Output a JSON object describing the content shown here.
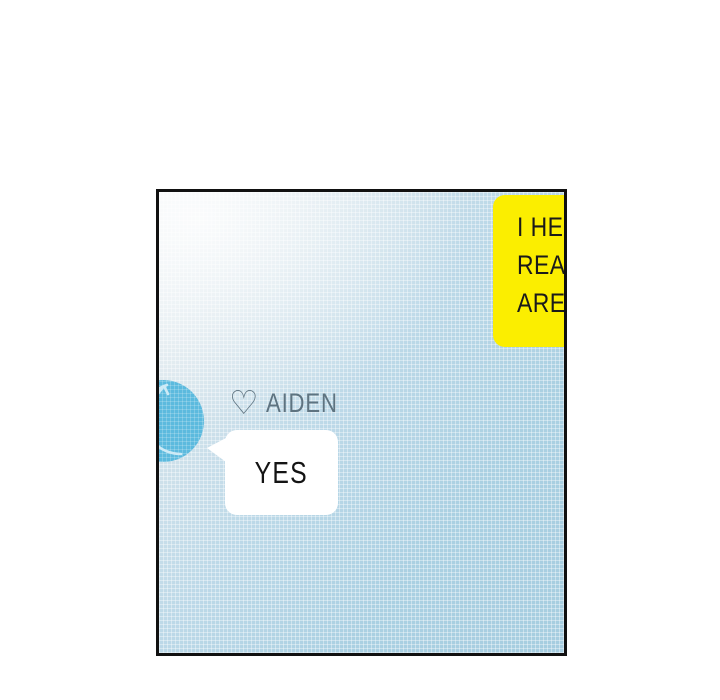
{
  "panel": {
    "yellow_bubble": {
      "lines": [
        "I HE",
        "REA",
        "ARE"
      ],
      "background": "#fbee00",
      "text_color": "#1a1a1a"
    },
    "character": {
      "heart_icon": "♡",
      "name": "AIDEN",
      "label_color": "#5e7380"
    },
    "white_bubble": {
      "text": "YES",
      "background": "#ffffff",
      "text_color": "#141414"
    },
    "colors": {
      "panel_border": "#111111",
      "background_light": "#eef2f4",
      "background_blue": "#a6cde0",
      "avatar_blue": "#5cbade",
      "avatar_sketch_line": "#cdeaf6",
      "page_background": "#ffffff"
    }
  }
}
